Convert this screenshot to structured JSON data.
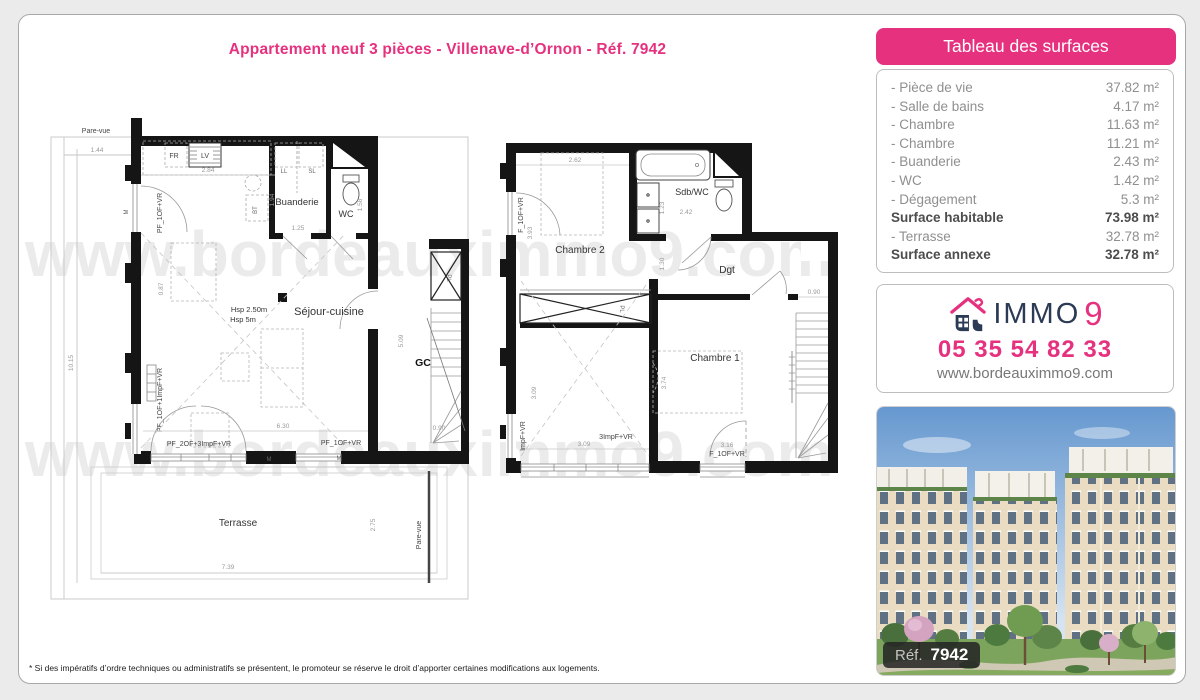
{
  "colors": {
    "accent": "#e6317f",
    "navy": "#2b3a55"
  },
  "header": {
    "title": "Appartement neuf 3 pièces - Villenave-d’Ornon - Réf. 7942"
  },
  "watermark": {
    "text": "www.bordeauximmo9.com"
  },
  "surfaces": {
    "title": "Tableau des surfaces",
    "rows": [
      {
        "label": "- Pièce de vie",
        "value": "37.82 m²"
      },
      {
        "label": "- Salle de bains",
        "value": "4.17 m²"
      },
      {
        "label": "- Chambre",
        "value": "11.63 m²"
      },
      {
        "label": "- Chambre",
        "value": "11.21 m²"
      },
      {
        "label": "- Buanderie",
        "value": "2.43 m²"
      },
      {
        "label": "- WC",
        "value": "1.42 m²"
      },
      {
        "label": "- Dégagement",
        "value": "5.3 m²"
      },
      {
        "label": "Surface habitable",
        "value": "73.98 m²"
      },
      {
        "label": "- Terrasse",
        "value": "32.78 m²"
      },
      {
        "label": "Surface annexe",
        "value": "32.78 m²"
      }
    ]
  },
  "agency": {
    "brand_main": "IMMO",
    "brand_digit": "9",
    "phone": "05 35 54 82 33",
    "website": "www.bordeauximmo9.com"
  },
  "photo": {
    "ref_label": "Réf.",
    "ref_value": "7942"
  },
  "footer": {
    "disclaimer": "* Si des impératifs d’ordre techniques ou administratifs se présentent, le promoteur se réserve le droit d’apporter certaines modifications aux logements."
  },
  "plan_left": {
    "pare_vue_top": "Pare-vue",
    "pare_vue_right": "Pare-vue",
    "fr": "FR",
    "lv": "LV",
    "bt": "BT",
    "ll": "LL",
    "sl": "SL",
    "buanderie": "Buanderie",
    "wc": "WC",
    "sejour": "Séjour-cuisine",
    "hsp1": "Hsp 2.50m",
    "hsp2": "Hsp 5m",
    "gc": "GC",
    "pl": "PL",
    "terrasse": "Terrasse",
    "m1": "M",
    "m2": "M",
    "m3": "M",
    "win_left_top": "PF_1OF+VR",
    "win_left_bottom": "PF_1OF+1ImpF+VR",
    "win_bottom_1": "PF_2OF+3ImpF+VR",
    "win_bottom_2": "PF_1OF+VR",
    "d144": "1.44",
    "d284": "2.84",
    "d194": "1.94",
    "d125": "1.25",
    "d158": "1.58",
    "d087": "0.87",
    "d1015": "10.15",
    "d509": "5.09",
    "d630": "6.30",
    "d090": "0.90",
    "d739": "7.39",
    "d275": "2.75"
  },
  "plan_right": {
    "chambre2": "Chambre 2",
    "chambre1": "Chambre 1",
    "sdbwc": "Sdb/WC",
    "dgt": "Dgt",
    "pl": "PL",
    "win_left_top": "F_1OF+VR",
    "win_left_bottom": "ImpF+VR",
    "win_bottom_1": "3ImpF+VR",
    "win_bottom_2": "F_1OF+VR",
    "d262": "2.62",
    "d123": "1.23",
    "d242": "2.42",
    "d393": "3.93",
    "d130": "1.30",
    "d090": "0.90",
    "d309v": "3.09",
    "d309h": "3.09",
    "d374": "3.74",
    "d316": "3.16"
  }
}
